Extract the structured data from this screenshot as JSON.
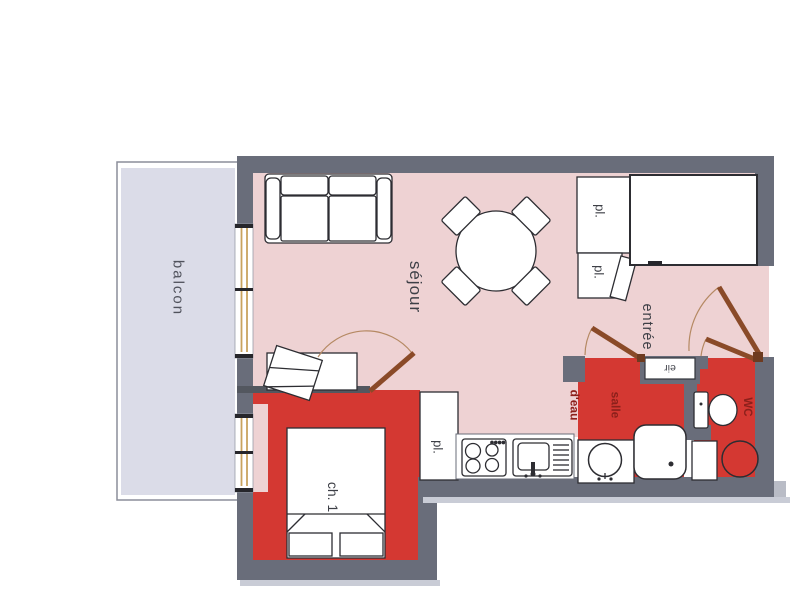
{
  "plan": {
    "title": "apartment floor plan",
    "rooms": {
      "balcony": {
        "label": "balcon"
      },
      "living_room": {
        "label": "séjour"
      },
      "entrance": {
        "label": "entrée"
      },
      "bedroom": {
        "label": "ch. 1"
      },
      "bathroom": {
        "label_line1": "salle",
        "label_line2": "d'eau"
      },
      "toilet": {
        "label": "WC"
      }
    },
    "closets": {
      "closet_top": {
        "label": "pl."
      },
      "closet_mid": {
        "label": "pl."
      },
      "closet_kitchen": {
        "label": "pl."
      }
    },
    "utility_box": {
      "label": "eir"
    },
    "colors": {
      "floor_pink": "#eed2d3",
      "highlight_red": "#d43832",
      "wall_gray": "#696d7a",
      "balcony_gray": "#dbdce8",
      "door_brown": "#8a4a28",
      "label_maroon": "#8c201b",
      "window_tan": "#c9a35f"
    }
  }
}
